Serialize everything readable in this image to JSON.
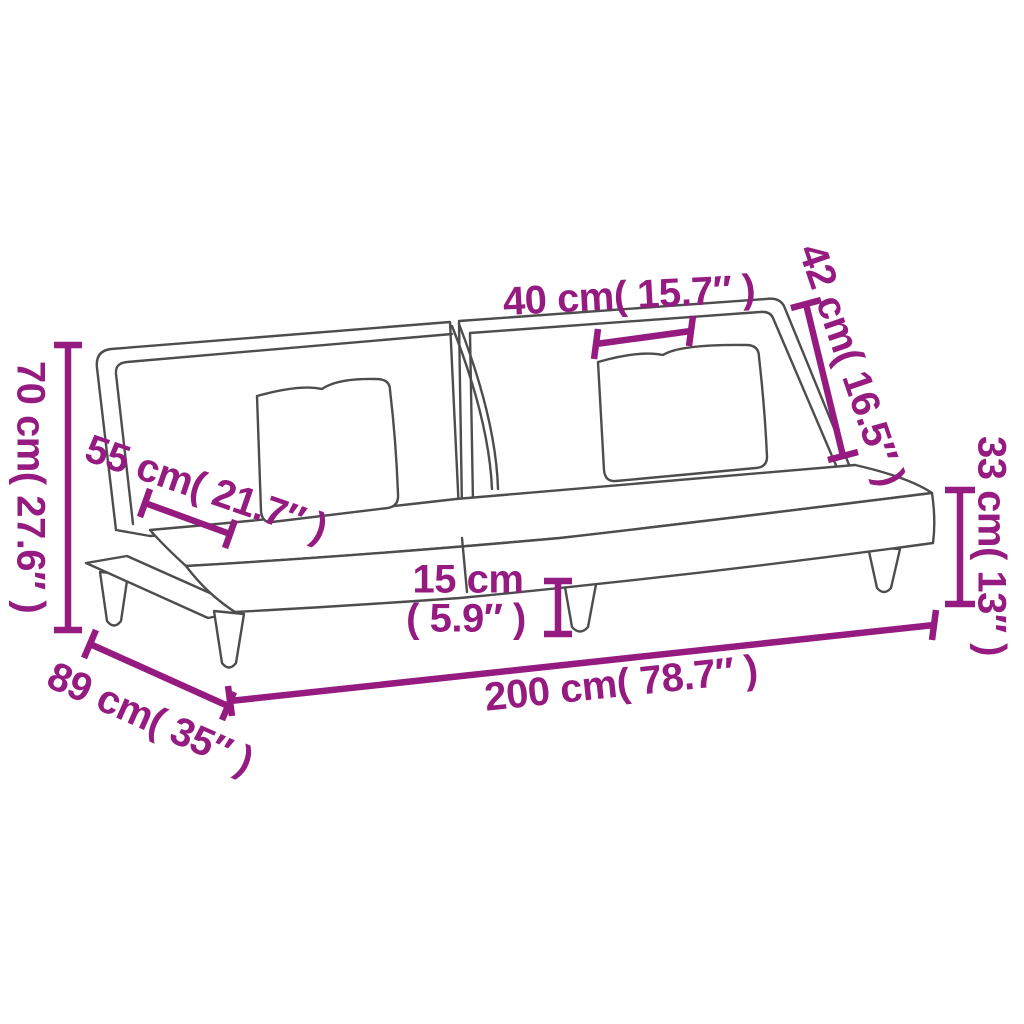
{
  "colors": {
    "accent": "#951b81",
    "line": "#4d4d4d"
  },
  "dimensions": {
    "back_height": "70 cm( 27.6″ )",
    "seat_depth": "55 cm( 21.7″ )",
    "pillow_width": "40 cm( 15.7″ )",
    "backrest_height": "42 cm( 16.5″ )",
    "seat_height": "33 cm( 13″ )",
    "leg_height_line1": "15 cm",
    "leg_height_line2": "( 5.9″ )",
    "total_length": "200 cm( 78.7″ )",
    "total_depth": "89 cm( 35″ )"
  }
}
